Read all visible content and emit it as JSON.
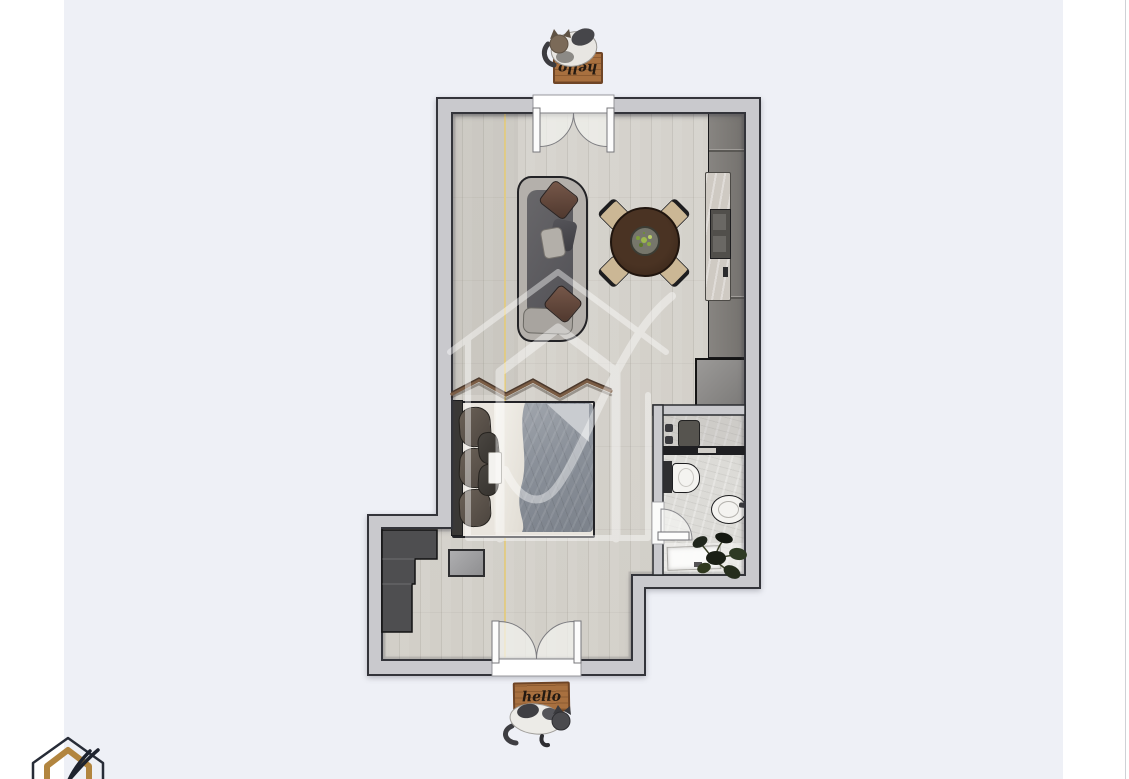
{
  "scene": {
    "description": "top-down 3D rendered studio apartment floor plan",
    "doormat_top_text": "hello",
    "doormat_bottom_text": "hello",
    "rooms": [
      "living-dining-area",
      "bedroom-area",
      "bathroom",
      "entry-hall"
    ],
    "furniture": [
      "sofa",
      "dining-table",
      "dining-chairs",
      "kitchen-counter",
      "closet",
      "wardrobe",
      "bed",
      "zigzag-wall-shelf",
      "stool",
      "toilet",
      "bathroom-sink",
      "vanity-sink",
      "shower-glass",
      "plant",
      "doormat-top",
      "doormat-bottom",
      "cat-top",
      "cat-bottom"
    ],
    "colors": {
      "background": "#eef0f6",
      "side_panels": "#ffffff",
      "wall_fill": "#c9c9cd",
      "wall_outline": "#33343a",
      "floor_wood": "#d4d1cb",
      "bathroom_floor": "#dcdbd7",
      "closet_dark": "#4e4e50",
      "kitchen_unit": "#7d7a76",
      "counter_marble": "#cfcac3",
      "table_wood": "#40291f",
      "chair_beige": "#cbb795",
      "sofa_body": "#b4b0ab",
      "duvet_gray": "#8a9099",
      "doormat_brown": "#a8703f",
      "guide_line_yellow": "#e2cb82",
      "watermark_white": "#ffffff",
      "logo_gold": "#b2853f",
      "logo_dark": "#272c37"
    }
  }
}
